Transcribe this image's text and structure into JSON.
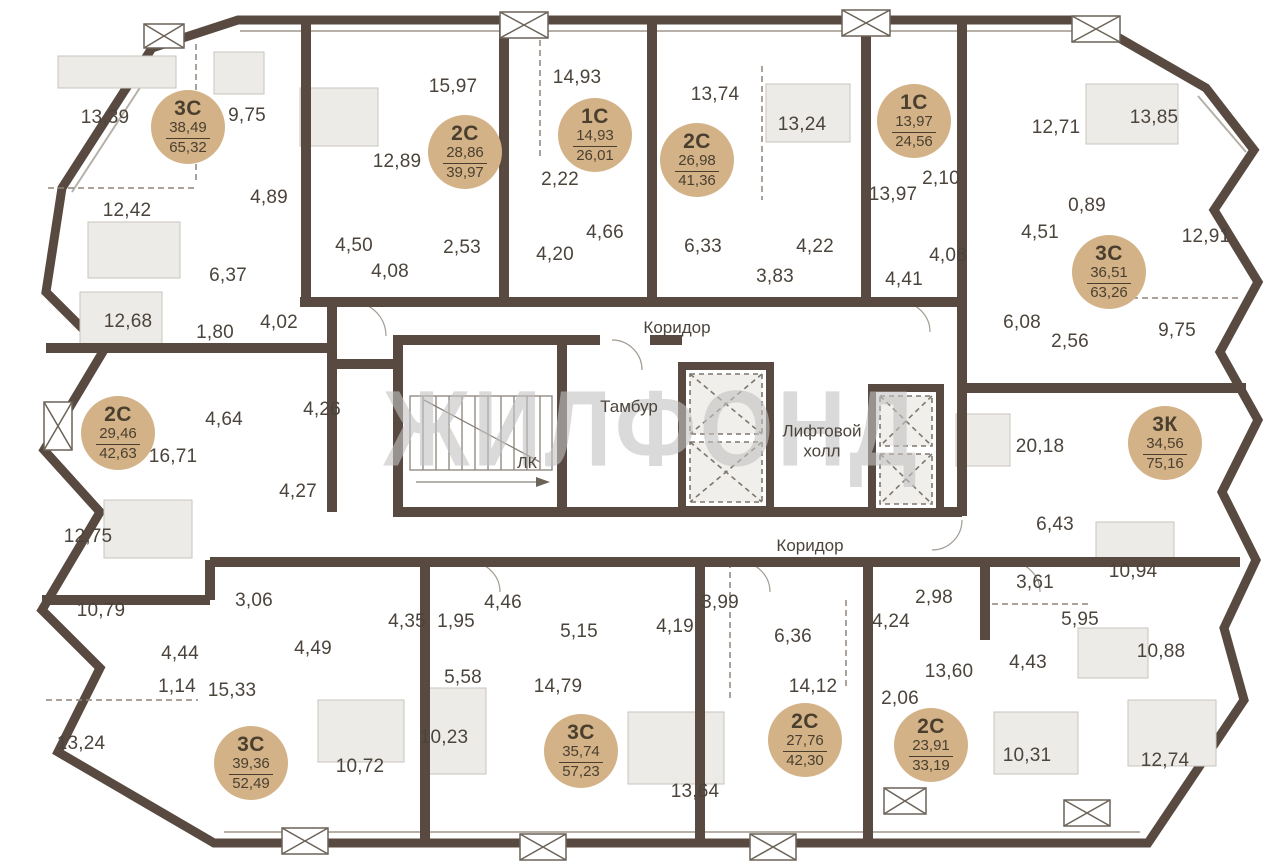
{
  "watermark": "ЖИЛФОНД",
  "colors": {
    "wall": "#584a40",
    "badge": "#d3b287",
    "badge_text": "#4a3f2f",
    "label": "#4b443c",
    "furniture": "#edebe7",
    "dashed": "#8d847a",
    "watermark": "#c2c2c2"
  },
  "core_labels": {
    "corridor_top": "Коридор",
    "corridor_bottom": "Коридор",
    "tambour": "Тамбур",
    "elevator_hall": "Лифтовой холл",
    "stairs": "ЛК"
  },
  "apartments": [
    {
      "type": "3С",
      "living": "38,49",
      "total": "65,32",
      "x": 188,
      "y": 127
    },
    {
      "type": "2С",
      "living": "28,86",
      "total": "39,97",
      "x": 465,
      "y": 152
    },
    {
      "type": "1С",
      "living": "14,93",
      "total": "26,01",
      "x": 595,
      "y": 135
    },
    {
      "type": "2С",
      "living": "26,98",
      "total": "41,36",
      "x": 697,
      "y": 160
    },
    {
      "type": "1С",
      "living": "13,97",
      "total": "24,56",
      "x": 914,
      "y": 121
    },
    {
      "type": "3С",
      "living": "36,51",
      "total": "63,26",
      "x": 1109,
      "y": 272
    },
    {
      "type": "2С",
      "living": "29,46",
      "total": "42,63",
      "x": 118,
      "y": 433
    },
    {
      "type": "3К",
      "living": "34,56",
      "total": "75,16",
      "x": 1165,
      "y": 443
    },
    {
      "type": "3С",
      "living": "39,36",
      "total": "52,49",
      "x": 251,
      "y": 763
    },
    {
      "type": "3С",
      "living": "35,74",
      "total": "57,23",
      "x": 581,
      "y": 751
    },
    {
      "type": "2С",
      "living": "27,76",
      "total": "42,30",
      "x": 805,
      "y": 740
    },
    {
      "type": "2С",
      "living": "23,91",
      "total": "33,19",
      "x": 931,
      "y": 745
    }
  ],
  "room_areas": [
    {
      "value": "13,39",
      "x": 105,
      "y": 118
    },
    {
      "value": "9,75",
      "x": 247,
      "y": 116
    },
    {
      "value": "12,42",
      "x": 127,
      "y": 211
    },
    {
      "value": "4,89",
      "x": 269,
      "y": 198
    },
    {
      "value": "6,37",
      "x": 228,
      "y": 276
    },
    {
      "value": "1,80",
      "x": 215,
      "y": 333
    },
    {
      "value": "4,02",
      "x": 279,
      "y": 323
    },
    {
      "value": "12,68",
      "x": 128,
      "y": 322
    },
    {
      "value": "15,97",
      "x": 453,
      "y": 87
    },
    {
      "value": "12,89",
      "x": 397,
      "y": 162
    },
    {
      "value": "4,50",
      "x": 354,
      "y": 246
    },
    {
      "value": "4,08",
      "x": 390,
      "y": 272
    },
    {
      "value": "2,53",
      "x": 462,
      "y": 248
    },
    {
      "value": "2,22",
      "x": 560,
      "y": 180
    },
    {
      "value": "4,20",
      "x": 555,
      "y": 255
    },
    {
      "value": "14,93",
      "x": 577,
      "y": 78
    },
    {
      "value": "4,66",
      "x": 605,
      "y": 233
    },
    {
      "value": "13,74",
      "x": 715,
      "y": 95
    },
    {
      "value": "6,33",
      "x": 703,
      "y": 247
    },
    {
      "value": "3,83",
      "x": 775,
      "y": 277
    },
    {
      "value": "13,24",
      "x": 802,
      "y": 125
    },
    {
      "value": "4,22",
      "x": 815,
      "y": 247
    },
    {
      "value": "13,97",
      "x": 893,
      "y": 195
    },
    {
      "value": "2,10",
      "x": 941,
      "y": 179
    },
    {
      "value": "4,08",
      "x": 948,
      "y": 256
    },
    {
      "value": "4,41",
      "x": 904,
      "y": 280
    },
    {
      "value": "4,51",
      "x": 1040,
      "y": 233
    },
    {
      "value": "12,71",
      "x": 1056,
      "y": 128
    },
    {
      "value": "13,85",
      "x": 1154,
      "y": 118
    },
    {
      "value": "0,89",
      "x": 1087,
      "y": 206
    },
    {
      "value": "12,91",
      "x": 1206,
      "y": 237
    },
    {
      "value": "9,75",
      "x": 1177,
      "y": 331
    },
    {
      "value": "6,08",
      "x": 1022,
      "y": 323
    },
    {
      "value": "2,56",
      "x": 1070,
      "y": 342
    },
    {
      "value": "16,71",
      "x": 173,
      "y": 457
    },
    {
      "value": "4,64",
      "x": 224,
      "y": 420
    },
    {
      "value": "4,26",
      "x": 322,
      "y": 410
    },
    {
      "value": "4,27",
      "x": 298,
      "y": 492
    },
    {
      "value": "12,75",
      "x": 88,
      "y": 537
    },
    {
      "value": "20,18",
      "x": 1040,
      "y": 447
    },
    {
      "value": "6,43",
      "x": 1055,
      "y": 525
    },
    {
      "value": "10,94",
      "x": 1133,
      "y": 572
    },
    {
      "value": "10,79",
      "x": 101,
      "y": 611
    },
    {
      "value": "4,44",
      "x": 180,
      "y": 654
    },
    {
      "value": "3,06",
      "x": 254,
      "y": 601
    },
    {
      "value": "1,14",
      "x": 177,
      "y": 687
    },
    {
      "value": "15,33",
      "x": 232,
      "y": 691
    },
    {
      "value": "13,24",
      "x": 81,
      "y": 744
    },
    {
      "value": "4,49",
      "x": 313,
      "y": 649
    },
    {
      "value": "10,72",
      "x": 360,
      "y": 767
    },
    {
      "value": "4,35",
      "x": 407,
      "y": 622
    },
    {
      "value": "1,95",
      "x": 456,
      "y": 622
    },
    {
      "value": "4,46",
      "x": 503,
      "y": 603
    },
    {
      "value": "5,15",
      "x": 579,
      "y": 632
    },
    {
      "value": "5,58",
      "x": 463,
      "y": 678
    },
    {
      "value": "14,79",
      "x": 558,
      "y": 687
    },
    {
      "value": "10,23",
      "x": 444,
      "y": 738
    },
    {
      "value": "13,64",
      "x": 695,
      "y": 792
    },
    {
      "value": "4,19",
      "x": 675,
      "y": 627
    },
    {
      "value": "3,99",
      "x": 720,
      "y": 603
    },
    {
      "value": "6,36",
      "x": 793,
      "y": 637
    },
    {
      "value": "14,12",
      "x": 813,
      "y": 687
    },
    {
      "value": "2,98",
      "x": 934,
      "y": 598
    },
    {
      "value": "4,24",
      "x": 891,
      "y": 622
    },
    {
      "value": "13,60",
      "x": 949,
      "y": 672
    },
    {
      "value": "2,06",
      "x": 900,
      "y": 699
    },
    {
      "value": "10,31",
      "x": 1027,
      "y": 756
    },
    {
      "value": "3,61",
      "x": 1035,
      "y": 583
    },
    {
      "value": "5,95",
      "x": 1080,
      "y": 620
    },
    {
      "value": "4,43",
      "x": 1028,
      "y": 663
    },
    {
      "value": "10,88",
      "x": 1161,
      "y": 652
    },
    {
      "value": "12,74",
      "x": 1165,
      "y": 761
    }
  ]
}
